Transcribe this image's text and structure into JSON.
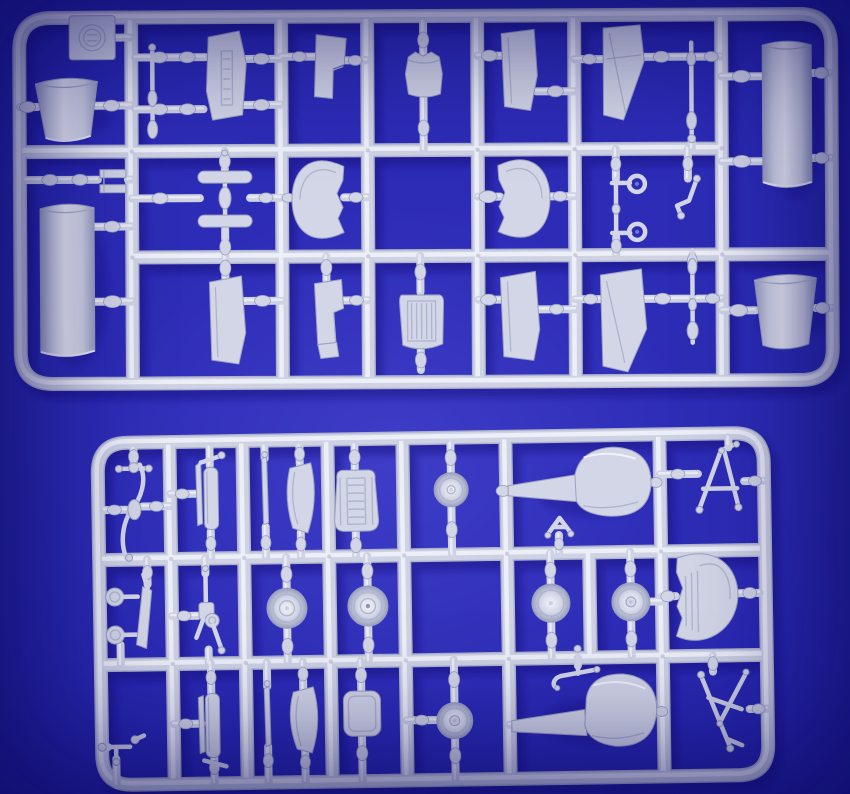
{
  "meta": {
    "description": "Photograph of two light grey injection-moulded plastic model-kit sprues lying on a bright royal-blue felt background. The large upper sprue holds aircraft parts: a manufacturer tag, two engine cowlings, two fuselage tube halves, cockpit sidewall panels, coaming half-moons, a radiator with ribs, a small fuel tank, windscreen panels, control rods and a gun yoke. The smaller lower sprue holds a propeller, exhaust stacks, a belted seat, five wheels, two paddle-shaped float boards, A-frame struts, a machine gun, a bomb rack and an instrument coaming."
  },
  "palette": {
    "bg": "#2d2cb6",
    "bg_light": "#4a49d6",
    "bg_dark": "#151394",
    "plastic": "#d3d6e6",
    "plastic_hi": "#f1f2f9",
    "plastic_mid": "#ced2e3",
    "plastic_lo": "#aeb4cd",
    "plastic_edge": "#9aa0bf",
    "shadow": "#12117a"
  },
  "sprues": [
    {
      "id": "sprue-top",
      "position": "upper",
      "parts": [
        "manufacturer-tag",
        "engine-cowling-left",
        "control-stick",
        "cockpit-sidewall-1",
        "cockpit-sidewall-2",
        "fuel-tank",
        "seat-back-1",
        "windscreen-panel-1",
        "strut-rod-1",
        "fuselage-tube-right",
        "clamp-bracket",
        "tail-spindle",
        "coaming-left",
        "coaming-right",
        "gun-yoke",
        "control-lever",
        "strut-rod-2",
        "engine-cowling-right",
        "fuselage-tube-left",
        "cockpit-sidewall-3",
        "cockpit-sidewall-4",
        "radiator-panel",
        "seat-back-2",
        "windscreen-panel-2"
      ]
    },
    {
      "id": "sprue-bottom",
      "position": "lower",
      "parts": [
        "propeller",
        "exhaust-stack-1",
        "blade-strip-1",
        "windscreen-wedge-1",
        "belted-seat",
        "wheel-small-1",
        "float-paddle-1",
        "a-frame-strut-1",
        "bomb-rack",
        "machine-gun",
        "wheel-1",
        "wheel-2",
        "mini-bracket",
        "wheel-3",
        "wheel-4",
        "instrument-coaming",
        "tail-skid",
        "exhaust-stack-2",
        "blade-strip-2",
        "windscreen-wedge-2",
        "stowage-box",
        "wheel-small-2",
        "anchor-handle",
        "float-paddle-2",
        "a-frame-strut-2"
      ]
    }
  ]
}
